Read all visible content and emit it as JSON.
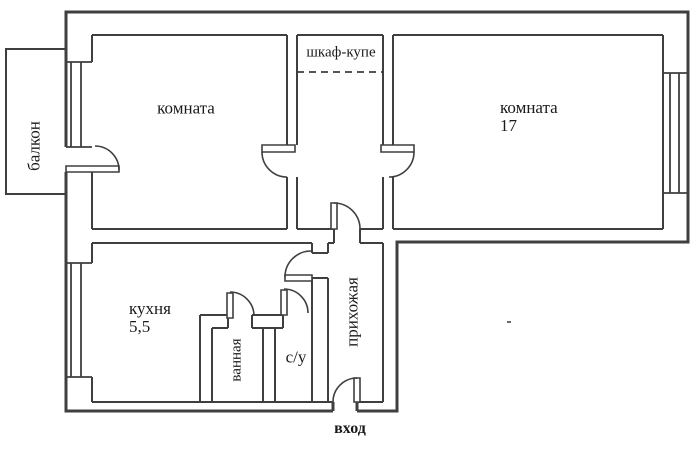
{
  "title": "apartment-floor-plan",
  "colors": {
    "wall": "#3f3f3f",
    "text": "#1a1a1a",
    "background": "#ffffff"
  },
  "rooms": {
    "balcony": {
      "label": "балкон"
    },
    "room_left": {
      "label": "комната"
    },
    "wardrobe": {
      "label": "шкаф-купе"
    },
    "room_right": {
      "label": "комната",
      "area": "17"
    },
    "kitchen": {
      "label": "кухня",
      "area": "5,5"
    },
    "bathroom": {
      "label": "ванная"
    },
    "wc": {
      "label": "с/у"
    },
    "hallway": {
      "label": "прихожая"
    },
    "entrance": {
      "label": "вход"
    }
  }
}
